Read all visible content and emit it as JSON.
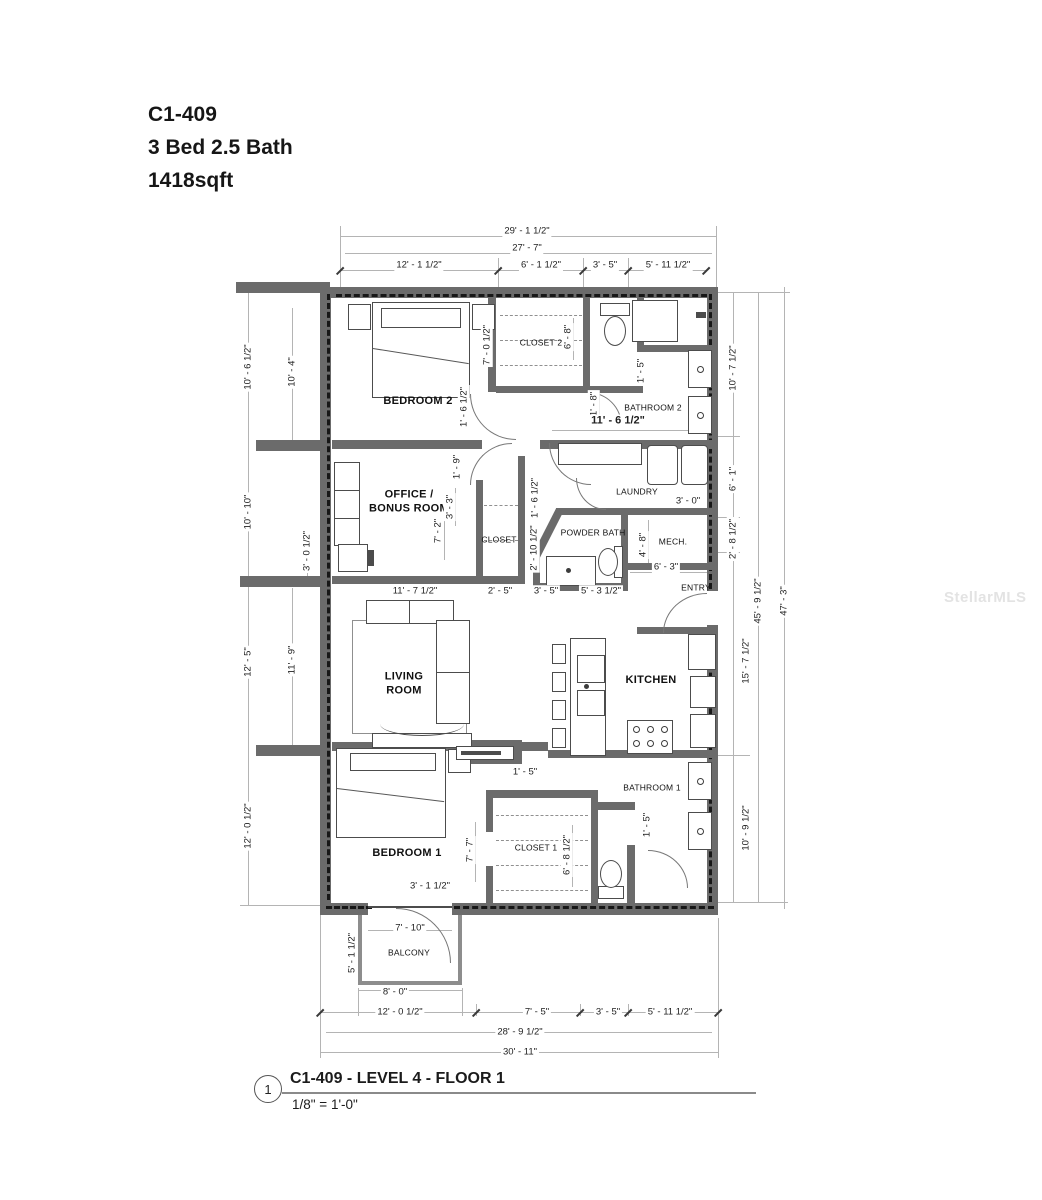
{
  "header": {
    "unit_code": "C1-409",
    "bed_bath": "3 Bed 2.5 Bath",
    "area": "1418sqft"
  },
  "watermark": "StellarMLS",
  "rooms": {
    "bedroom2": "BEDROOM 2",
    "closet2": "CLOSET 2",
    "bathroom2": "BATHROOM 2",
    "office": "OFFICE /\nBONUS ROOM",
    "office_closet": "CLOSET",
    "powder": "POWDER BATH",
    "laundry": "LAUNDRY",
    "mech": "MECH.",
    "entry": "ENTRY",
    "living": "LIVING\nROOM",
    "kitchen": "KITCHEN",
    "bedroom1": "BEDROOM 1",
    "closet1": "CLOSET 1",
    "bathroom1": "BATHROOM 1",
    "balcony": "BALCONY"
  },
  "dims": {
    "top": [
      "29' - 1 1/2\"",
      "27' - 7\"",
      "12' - 1 1/2\"",
      "6' - 1 1/2\"",
      "3' - 5\"",
      "5' - 11 1/2\""
    ],
    "left": [
      "10' - 6 1/2\"",
      "10' - 4\"",
      "10' - 10\"",
      "3' - 0 1/2\"",
      "12' - 5\"",
      "11' - 9\"",
      "12' - 0 1/2\"",
      "5' - 1 1/2\""
    ],
    "right": [
      "10' - 7 1/2\"",
      "6' - 1\"",
      "2' - 8 1/2\"",
      "15' - 7 1/2\"",
      "10' - 9 1/2\"",
      "45' - 9 1/2\"",
      "47' - 3\""
    ],
    "bottom": [
      "7' - 10\"",
      "8' - 0\"",
      "12' - 0 1/2\"",
      "7' - 5\"",
      "3' - 5\"",
      "5' - 11 1/2\"",
      "28' - 9 1/2\"",
      "30' - 11\""
    ],
    "interior": [
      "7' - 0 1/2\"",
      "1' - 6 1/2\"",
      "6' - 8\"",
      "1' - 5\"",
      "1' - 8\"",
      "11' - 6 1/2\"",
      "1' - 9\"",
      "3' - 3\"",
      "7' - 2\"",
      "1' - 6 1/2\"",
      "2' - 10 1/2\"",
      "11' - 7 1/2\"",
      "2' - 5\"",
      "3' - 5\"",
      "5' - 3 1/2\"",
      "3' - 0\"",
      "4' - 8\"",
      "6' - 3\"",
      "1' - 5\"",
      "7' - 7\"",
      "6' - 8 1/2\"",
      "3' - 1 1/2\"",
      "1' - 5\""
    ]
  },
  "titleblock": {
    "sheet_number": "1",
    "title": "C1-409 - LEVEL 4 - FLOOR 1",
    "scale": "1/8\" = 1'-0\""
  }
}
